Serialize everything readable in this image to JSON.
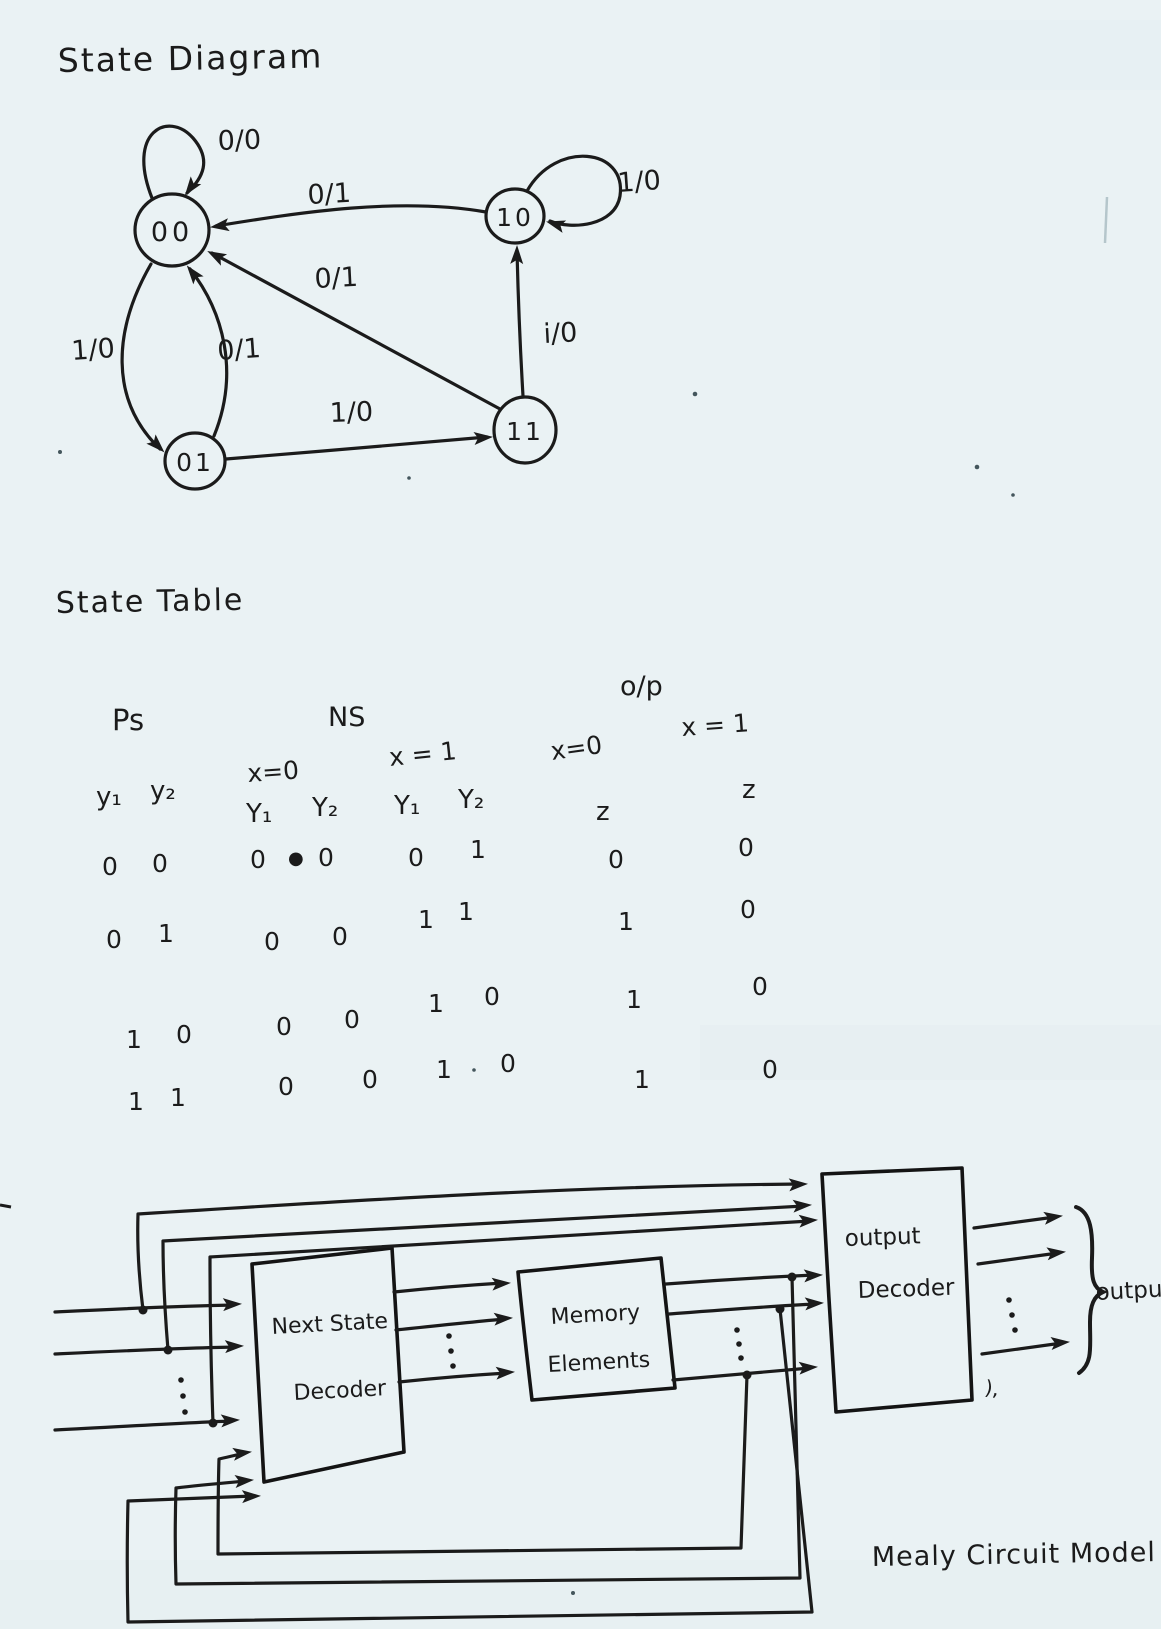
{
  "titles": {
    "state_diagram": "State Diagram",
    "state_table": "State Table",
    "caption": "Mealy Circuit Model"
  },
  "state_diagram": {
    "states": {
      "s00": "00",
      "s10": "10",
      "s01": "01",
      "s11": "11"
    },
    "edges": {
      "self_00": "0/0",
      "self_10": "1/0",
      "e_10_00": "0/1",
      "e_11_00": "0/1",
      "e_00_01": "1/0",
      "e_01_00": "0/1",
      "e_01_11": "1/0",
      "e_11_10": "i/0"
    }
  },
  "state_table": {
    "headers": {
      "ps": "Ps",
      "ns": "NS",
      "op": "o/p",
      "ns_x0": "x=0",
      "ns_x1": "x = 1",
      "op_x0": "x=0",
      "op_x1": "x = 1",
      "z0": "z",
      "z1": "z",
      "y1": "y₁",
      "y2": "y₂",
      "Y1": "Y₁",
      "Y2": "Y₂"
    },
    "ink_blob": "●",
    "rows": [
      {
        "ps": [
          "0",
          "0"
        ],
        "ns_x0": [
          "0",
          "0"
        ],
        "ns_x1": [
          "0",
          "1"
        ],
        "z_x0": "0",
        "z_x1": "0"
      },
      {
        "ps": [
          "0",
          "1"
        ],
        "ns_x0": [
          "0",
          "0"
        ],
        "ns_x1": [
          "1",
          "1"
        ],
        "z_x0": "1",
        "z_x1": "0"
      },
      {
        "ps": [
          "1",
          "0"
        ],
        "ns_x0": [
          "0",
          "0"
        ],
        "ns_x1": [
          "1",
          "0"
        ],
        "z_x0": "1",
        "z_x1": "0"
      },
      {
        "ps": [
          "1",
          "1"
        ],
        "ns_x0": [
          "0",
          "0"
        ],
        "ns_x1": [
          "1",
          "0"
        ],
        "z_x0": "1",
        "z_x1": "0"
      }
    ]
  },
  "block_diagram": {
    "next_state_decoder": {
      "line1": "Next State",
      "line2": "Decoder"
    },
    "memory_elements": {
      "line1": "Memory",
      "line2": "Elements"
    },
    "output_decoder": {
      "line1": "output",
      "line2": "Decoder"
    },
    "outputs_label": "outputs",
    "stray_mark": "),"
  },
  "colors": {
    "ink": "#1b1b1b",
    "paper": "#eaf2f4"
  }
}
